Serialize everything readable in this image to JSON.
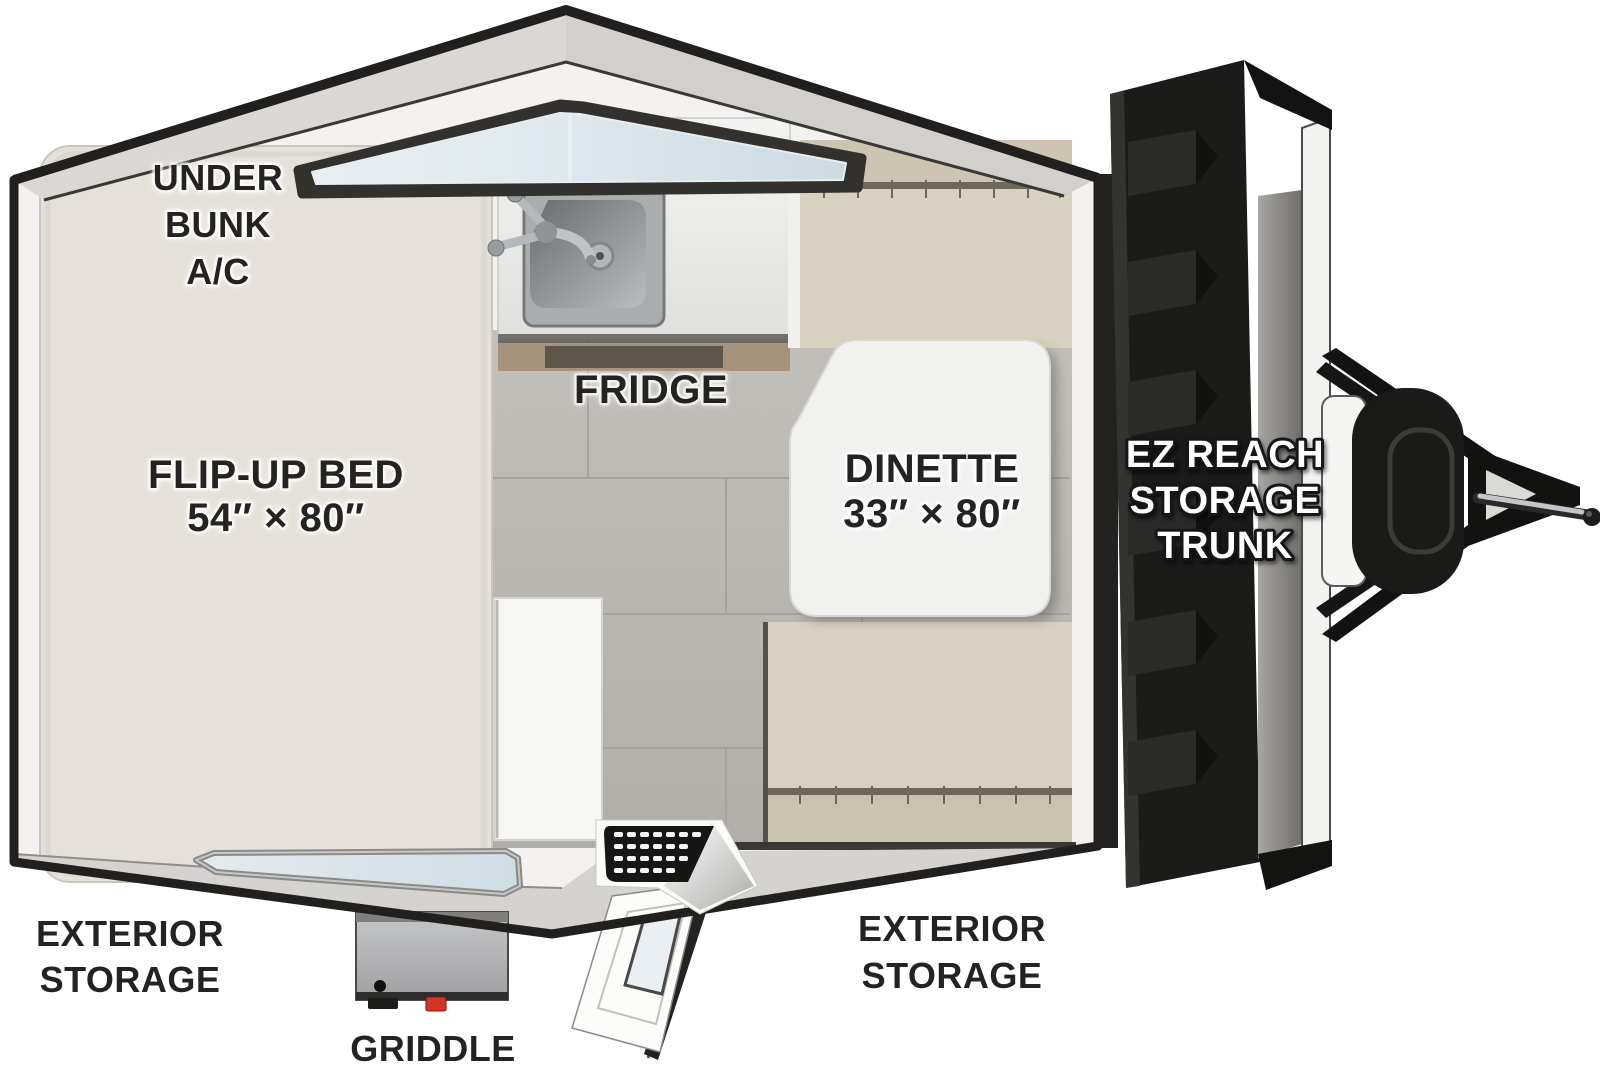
{
  "floorplan": {
    "labels": {
      "under_bunk_ac": [
        "UNDER",
        "BUNK",
        "A/C"
      ],
      "flip_up_bed": {
        "name": "FLIP-UP BED",
        "size": "54″ × 80″"
      },
      "fridge": "FRIDGE",
      "dinette": {
        "name": "DINETTE",
        "size": "33″ × 80″"
      },
      "ez_reach_storage_trunk": [
        "EZ REACH",
        "STORAGE",
        "TRUNK"
      ],
      "exterior_storage_left": [
        "EXTERIOR",
        "STORAGE"
      ],
      "exterior_storage_right": [
        "EXTERIOR",
        "STORAGE"
      ],
      "griddle": "GRIDDLE"
    },
    "colors": {
      "bed_mattress": "#e4e0d9",
      "bench_cushion": "#d9d1bf",
      "floor_tile": "#bab7b2",
      "roof_band": "#d9d7d3",
      "wall_outline": "#21201e",
      "window_glass": "#dde8ee",
      "trunk_door": "#1b1b1a",
      "label_dark": "#242321",
      "label_light": "#ffffff",
      "griddle_valve": "#d2362a"
    }
  }
}
